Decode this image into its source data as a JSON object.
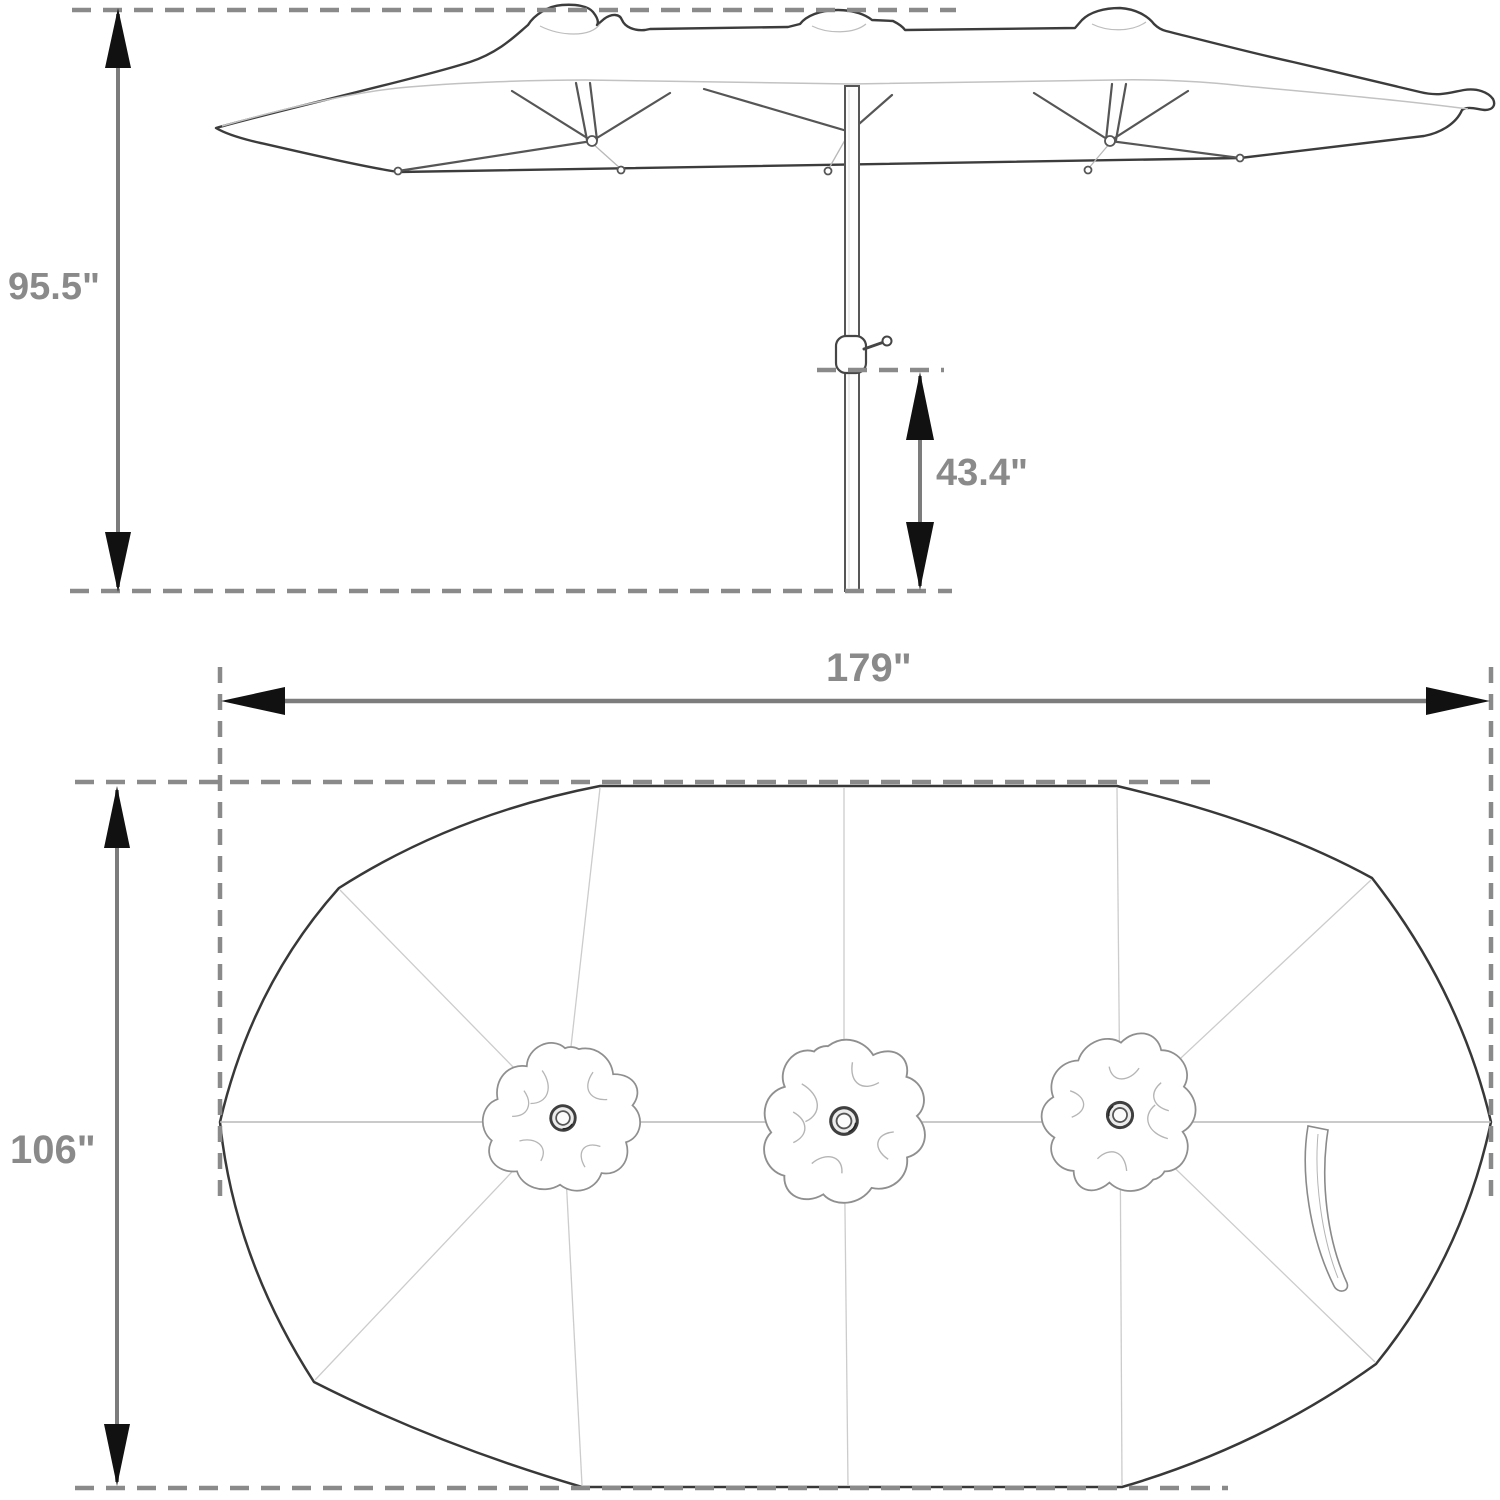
{
  "diagram": {
    "kind": "patio-umbrella-dimension-diagram",
    "labels": {
      "overall_height": "95.5\"",
      "pole_bottom_height": "43.4\"",
      "canopy_width": "179\"",
      "canopy_depth": "106\""
    },
    "colors": {
      "background": "#ffffff",
      "dimension_gray": "#8a8a8a",
      "dimension_line": "#7c7c7c",
      "arrowhead_black": "#111111",
      "outline_dark": "#3c3c3c",
      "rib_gray": "#565656",
      "seam_light": "#cccccc"
    }
  }
}
